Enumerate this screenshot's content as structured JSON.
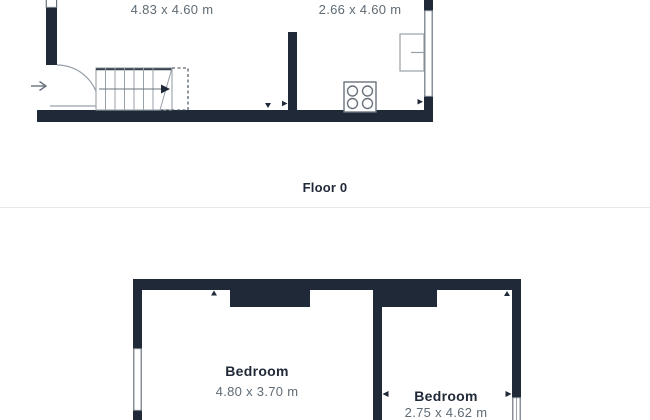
{
  "colors": {
    "wall": "#1f2937",
    "dim_text": "#5f6b74",
    "label_text": "#1f2937",
    "fixture_stroke": "#6a737d",
    "light_stroke": "#98a0a8",
    "divider": "#e7e8ea"
  },
  "floor0": {
    "label": "Floor 0",
    "rooms": [
      {
        "dims": "4.83 x 4.60 m"
      },
      {
        "dims": "2.66 x 4.60 m"
      }
    ]
  },
  "floor1": {
    "rooms": [
      {
        "name": "Bedroom",
        "dims": "4.80 x 3.70 m"
      },
      {
        "name": "Bedroom",
        "dims": "2.75 x 4.62 m"
      }
    ]
  },
  "symbols": {
    "entry_arrow": "right-arrow",
    "door": "quarter-circle-door-swing",
    "stairs": "staircase-with-up-arrow",
    "stove": "four-burner-hob",
    "counter": "kitchen-counter-unit",
    "window": "double-line-window",
    "dimension_marker": "small-triangle-arrow"
  }
}
